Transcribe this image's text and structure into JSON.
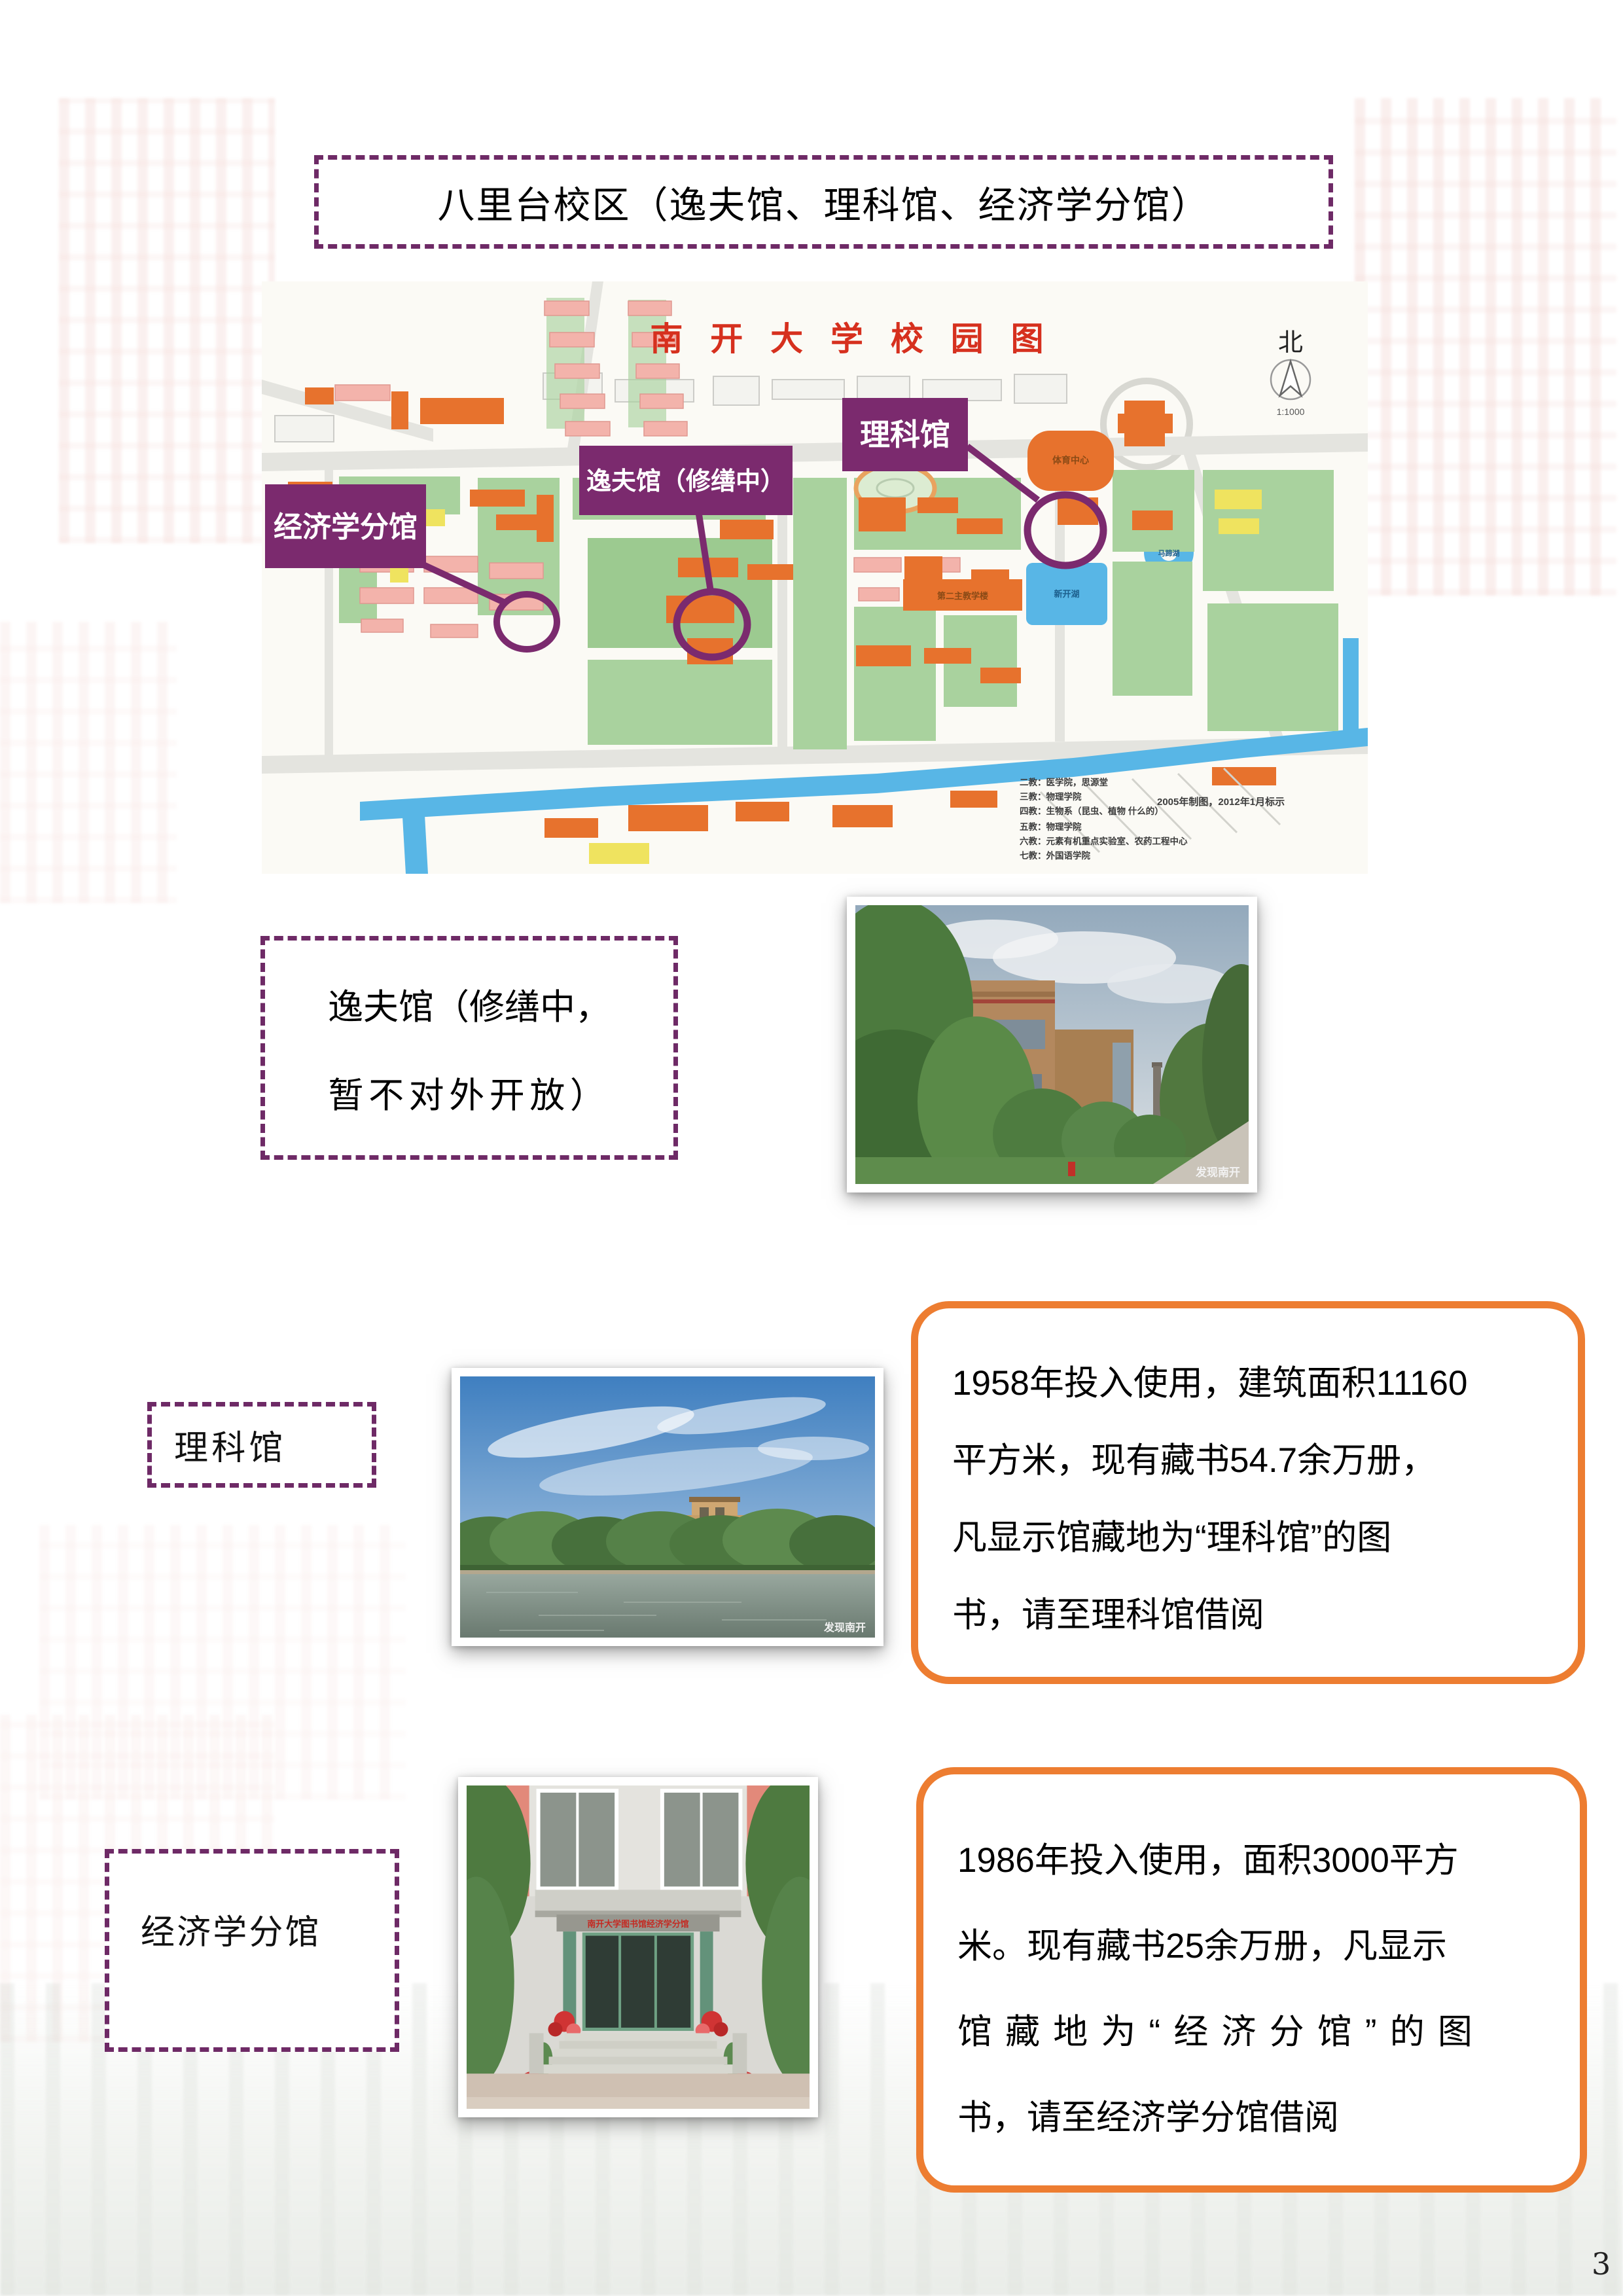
{
  "page_number": "3",
  "title": "八里台校区（逸夫馆、理科馆、经济学分馆）",
  "map": {
    "title": "南 开 大 学 校 园 图",
    "compass": "北",
    "scale": "1:1000",
    "highlight_labels": {
      "economics": "经济学分馆",
      "yifu": "逸夫馆（修缮中）",
      "science": "理科馆"
    },
    "minor_labels": {
      "sports_center": "体育中心",
      "second_teaching": "第二主教学楼",
      "xinkai_lake": "新开湖",
      "mati_lake": "马蹄湖",
      "apec": "APEC大楼"
    },
    "legend": [
      "二教：医学院，思源堂",
      "三教：物理学院",
      "四教：生物系（昆虫、植物 什么的）",
      "五教：物理学院",
      "六教：元素有机重点实验室、农药工程中心",
      "七教：外国语学院"
    ],
    "note": "2005年制图，2012年1月标示"
  },
  "sections": {
    "yifu": {
      "label_lines": [
        "逸夫馆（修缮中，",
        "暂不对外开放）"
      ]
    },
    "science": {
      "label": "理科馆",
      "bubble_lines": [
        "1958年投入使用，建筑面积11160",
        "平方米，现有藏书54.7余万册，",
        "凡显示馆藏地为“理科馆”的图",
        "书，请至理科馆借阅"
      ]
    },
    "economics": {
      "label": "经济学分馆",
      "door_sign": "南开大学图书馆经济学分馆",
      "bubble_lines": [
        "1986年投入使用，面积3000平方",
        "米。现有藏书25余万册，凡显示",
        "馆藏地为“经济分馆”的图",
        "书，请至经济学分馆借阅"
      ]
    }
  },
  "photos": {
    "watermark": "发现南开"
  },
  "colors": {
    "accent_purple": "#6e2a66",
    "map_label_purple": "#7b2a6e",
    "accent_orange": "#ed7d31",
    "map_title_red": "#d6301e"
  }
}
